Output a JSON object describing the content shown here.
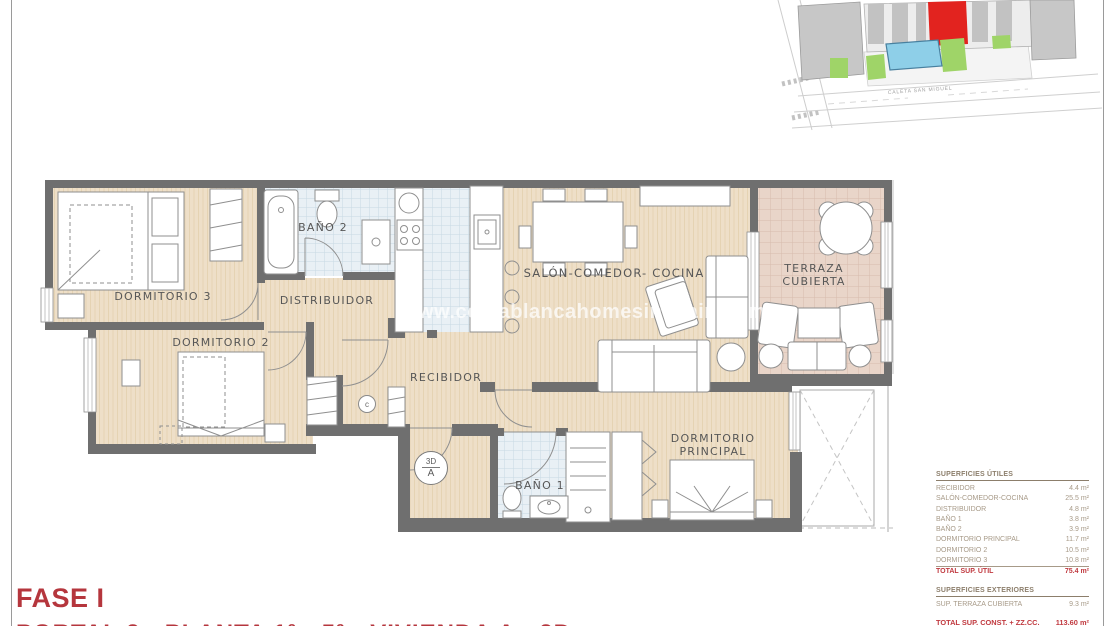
{
  "page": {
    "watermark": "www.costablancahomesinspain.com",
    "phase_label": "FASE I",
    "unit_label": "PORTAL 2 - PLANTA 1ª - 5ª - VIVIENDA A - 2D"
  },
  "site_plan": {
    "street_label": "CALETA SAN MIGUEL",
    "highlight_color": "#e2231f"
  },
  "floor_plan": {
    "rooms": {
      "dormitorio3": "DORMITORIO 3",
      "dormitorio2": "DORMITORIO 2",
      "bano2": "BAÑO 2",
      "distribuidor": "DISTRIBUIDOR",
      "recibidor": "RECIBIDOR",
      "salon": "SALÓN-COMEDOR- COCINA",
      "terraza_line1": "TERRAZA",
      "terraza_line2": "CUBIERTA",
      "bano1": "BAÑO 1",
      "dorm_principal_line1": "DORMITORIO",
      "dorm_principal_line2": "PRINCIPAL"
    },
    "symbols": {
      "compass_top": "3D",
      "compass_bottom": "A",
      "closet_mark": "c"
    }
  },
  "areas": {
    "utiles": {
      "title": "SUPERFICIES ÚTILES",
      "rows": [
        {
          "label": "RECIBIDOR",
          "value": "4.4 m²"
        },
        {
          "label": "SALÓN-COMEDOR-COCINA",
          "value": "25.5 m²"
        },
        {
          "label": "DISTRIBUIDOR",
          "value": "4.8 m²"
        },
        {
          "label": "BAÑO 1",
          "value": "3.8 m²"
        },
        {
          "label": "BAÑO 2",
          "value": "3.9 m²"
        },
        {
          "label": "DORMITORIO PRINCIPAL",
          "value": "11.7 m²"
        },
        {
          "label": "DORMITORIO 2",
          "value": "10.5 m²"
        },
        {
          "label": "DORMITORIO 3",
          "value": "10.8 m²"
        }
      ],
      "total": {
        "label": "TOTAL SUP. ÚTIL",
        "value": "75.4 m²"
      }
    },
    "exteriores": {
      "title": "SUPERFICIES EXTERIORES",
      "rows": [
        {
          "label": "SUP. TERRAZA CUBIERTA",
          "value": "9.3 m²"
        }
      ],
      "total": {
        "label": "TOTAL SUP. CONST. + ZZ.CC.",
        "value": "113.60 m²"
      }
    }
  },
  "colors": {
    "wall": "#6f6f6f",
    "accent_red": "#c0393f",
    "floor_wood": "#eedfc8",
    "floor_tile": "#e9f0f5",
    "floor_terrace": "#e9d5c9"
  }
}
